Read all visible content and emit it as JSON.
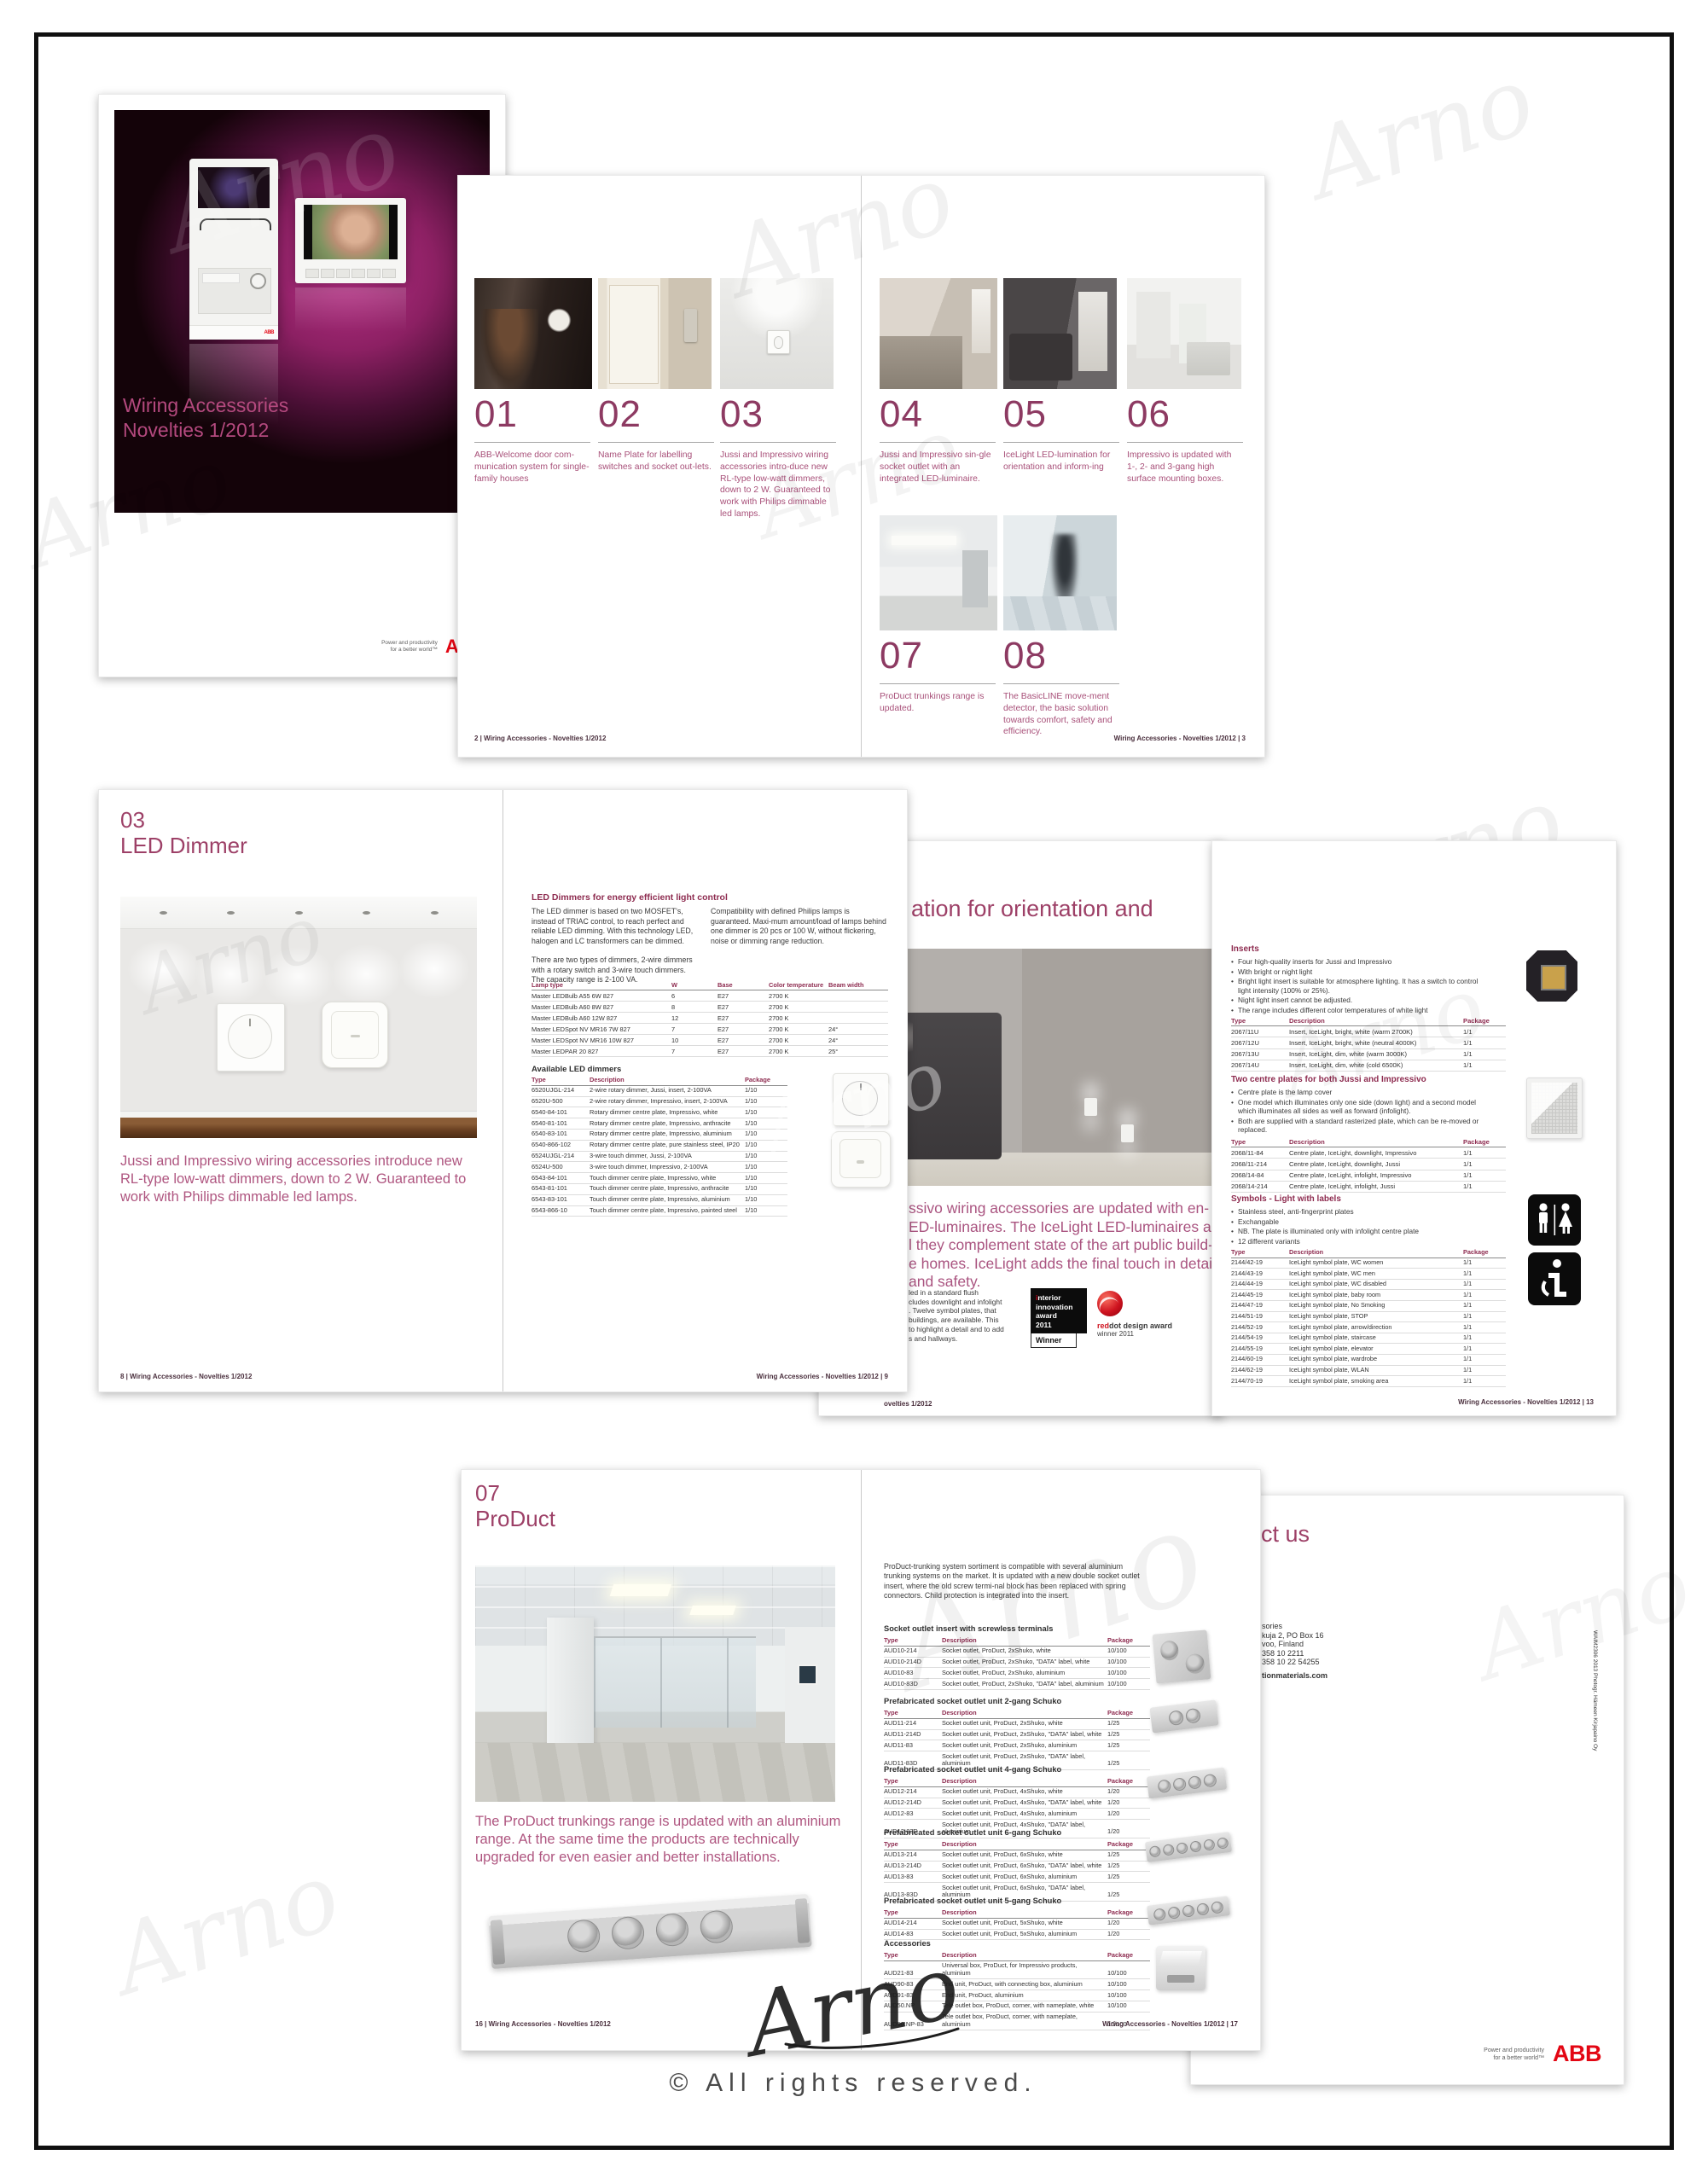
{
  "watermark": {
    "text": "Arno"
  },
  "signature": {
    "text": "Arno"
  },
  "copyright": "© All rights reserved.",
  "brand": {
    "abb": "ABB",
    "tagline1": "Power and productivity",
    "tagline2": "for a better world™"
  },
  "cover": {
    "title1": "Wiring Accessories",
    "title2": "Novelties 1/2012"
  },
  "spread1": {
    "footer_left": "2 | Wiring Accessories - Novelties 1/2012",
    "footer_right": "Wiring Accessories - Novelties 1/2012 | 3",
    "items": [
      {
        "num": "01",
        "text": "ABB-Welcome door com-munication system for single-family houses"
      },
      {
        "num": "02",
        "text": "Name Plate for labelling switches and socket out-lets."
      },
      {
        "num": "03",
        "text": "Jussi and Impressivo wiring accessories intro-duce new RL-type low-watt dimmers, down to 2 W. Guaranteed to work with Philips dimmable led lamps."
      },
      {
        "num": "04",
        "text": "Jussi and Impressivo sin-gle socket outlet with an integrated LED-luminaire."
      },
      {
        "num": "05",
        "text": "IceLight LED-lumination for orientation and inform-ing"
      },
      {
        "num": "06",
        "text": "Impressivo is updated with 1-, 2- and 3-gang high surface mounting boxes."
      },
      {
        "num": "07",
        "text": "ProDuct trunkings range is updated."
      },
      {
        "num": "08",
        "text": "The BasicLINE move-ment detector, the basic solution towards comfort, safety and efficiency."
      }
    ]
  },
  "led": {
    "num": "03",
    "title": "LED Dimmer",
    "paragraph": "Jussi and Impressivo wiring accessories introduce new RL-type low-watt dimmers, down to 2 W. Guaranteed to work with Philips dimmable led lamps.",
    "footer_left": "8 | Wiring Accessories - Novelties 1/2012",
    "footer_right": "Wiring Accessories - Novelties 1/2012 | 9",
    "heading": "LED Dimmers for energy efficient light control",
    "col1a": "The LED dimmer is based on two MOSFET's, instead of TRIAC control, to reach perfect and reliable LED dimming. With this technology LED, halogen and LC transformers can be dimmed.",
    "col1b": "There are two types of dimmers, 2-wire dimmers with a rotary switch and 3-wire touch dimmers. The capacity range is 2-100 VA.",
    "col2": "Compatibility with defined Philips lamps is guaranteed. Maxi-mum amount/load of lamps behind one dimmer is 20 pcs or 100 W, without flickering, noise or dimming range reduction.",
    "lamp_headers": [
      "Lamp type",
      "W",
      "Base",
      "Color temperature",
      "Beam width"
    ],
    "lamp_rows": [
      [
        "Master LEDBulb A55 6W 827",
        "6",
        "E27",
        "2700 K",
        ""
      ],
      [
        "Master LEDBulb A60 8W 827",
        "8",
        "E27",
        "2700 K",
        ""
      ],
      [
        "Master LEDBulb A60 12W 827",
        "12",
        "E27",
        "2700 K",
        ""
      ],
      [
        "Master LEDSpot NV MR16 7W 827",
        "7",
        "E27",
        "2700 K",
        "24°"
      ],
      [
        "Master LEDSpot NV MR16 10W 827",
        "10",
        "E27",
        "2700 K",
        "24°"
      ],
      [
        "Master LEDPAR 20 827",
        "7",
        "E27",
        "2700 K",
        "25°"
      ]
    ],
    "dimmers_heading": "Available LED dimmers",
    "tdp_headers": [
      "Type",
      "Description",
      "Package"
    ],
    "dimmer_rows": [
      [
        "6520UJGL-214",
        "2-wire rotary dimmer, Jussi, insert, 2-100VA",
        "1/10"
      ],
      [
        "6520U-500",
        "2-wire rotary dimmer, Impressivo, insert, 2-100VA",
        "1/10"
      ],
      [
        "6540-84-101",
        "Rotary dimmer centre plate, Impressivo, white",
        "1/10"
      ],
      [
        "6540-81-101",
        "Rotary dimmer centre plate, Impressivo, anthracite",
        "1/10"
      ],
      [
        "6540-83-101",
        "Rotary dimmer centre plate, Impressivo, aluminium",
        "1/10"
      ],
      [
        "6540-866-102",
        "Rotary dimmer centre plate, pure stainless steel, IP20",
        "1/10"
      ],
      [
        "6524UJGL-214",
        "3-wire touch dimmer, Jussi, 2-100VA",
        "1/10"
      ],
      [
        "6524U-500",
        "3-wire touch dimmer, Impressivo, 2-100VA",
        "1/10"
      ],
      [
        "6543-84-101",
        "Touch dimmer centre plate, Impressivo, white",
        "1/10"
      ],
      [
        "6543-81-101",
        "Touch dimmer centre plate, Impressivo, anthracite",
        "1/10"
      ],
      [
        "6543-83-101",
        "Touch dimmer centre plate, Impressivo, aluminium",
        "1/10"
      ],
      [
        "6543-866-10",
        "Touch dimmer centre plate, Impressivo, painted steel",
        "1/10"
      ]
    ]
  },
  "ice": {
    "heading_fragment": "ation for orientation and",
    "body_lines": [
      "ssivo wiring accessories are updated with en-",
      "ED-luminaires. The IceLight LED-luminaires are",
      "l they complement state of the art public build-",
      "e homes. IceLight adds the final touch in detail",
      "and safety."
    ],
    "small_lines": [
      "led in a standard flush",
      "cludes downlight and infolight",
      ". Twelve symbol plates, that",
      "buildings, are available. This",
      "to highlight a detail and to add",
      "s and hallways."
    ],
    "award1": {
      "i": "i",
      "line1": "nterior",
      "line2": "innovation",
      "line3": "award",
      "line4": "2011",
      "winner": "Winner"
    },
    "award2": {
      "red": "red",
      "rest": "dot design award",
      "line2": "winner 2011"
    },
    "footer_fragment": "ovelties 1/2012",
    "right": {
      "headers": [
        "Type",
        "Description",
        "Package"
      ],
      "inserts_heading": "Inserts",
      "inserts_bullets": [
        "Four high-quality inserts for Jussi and Impressivo",
        "With bright or night light",
        "Bright light insert is suitable for atmosphere lighting. It has a switch to control light intensity (100% or 25%).",
        "Night light insert cannot be adjusted.",
        "The range includes different color temperatures of white light"
      ],
      "inserts_rows": [
        [
          "2067/11U",
          "Insert, IceLight, bright, white (warm 2700K)",
          "1/1"
        ],
        [
          "2067/12U",
          "Insert, IceLight, bright, white (neutral 4000K)",
          "1/1"
        ],
        [
          "2067/13U",
          "Insert, IceLight, dim, white (warm 3000K)",
          "1/1"
        ],
        [
          "2067/14U",
          "Insert, IceLight, dim, white (cold 6500K)",
          "1/1"
        ]
      ],
      "plates_heading": "Two centre plates for both Jussi and Impressivo",
      "plates_bullets": [
        "Centre plate is the lamp cover",
        "One model which illuminates only one side (down light) and a second model which illuminates all sides as well as forward (infolight).",
        "Both are supplied with a standard rasterized plate, which can be re-moved or replaced."
      ],
      "plates_rows": [
        [
          "2068/11-84",
          "Centre plate, IceLight, downlight, Impressivo",
          "1/1"
        ],
        [
          "2068/11-214",
          "Centre plate, IceLight, downlight, Jussi",
          "1/1"
        ],
        [
          "2068/14-84",
          "Centre plate, IceLight, infolight, Impressivo",
          "1/1"
        ],
        [
          "2068/14-214",
          "Centre plate, IceLight, infolight, Jussi",
          "1/1"
        ]
      ],
      "symbols_heading": "Symbols - Light with labels",
      "symbols_bullets": [
        "Stainless steel, anti-fingerprint plates",
        "Exchangable",
        "NB. The plate is illuminated only with infolight centre plate",
        "12 different variants"
      ],
      "symbols_rows": [
        [
          "2144/42-19",
          "IceLight symbol plate, WC women",
          "1/1"
        ],
        [
          "2144/43-19",
          "IceLight symbol plate, WC men",
          "1/1"
        ],
        [
          "2144/44-19",
          "IceLight symbol plate, WC disabled",
          "1/1"
        ],
        [
          "2144/45-19",
          "IceLight symbol plate, baby room",
          "1/1"
        ],
        [
          "2144/47-19",
          "IceLight symbol plate, No Smoking",
          "1/1"
        ],
        [
          "2144/51-19",
          "IceLight symbol plate, STOP",
          "1/1"
        ],
        [
          "2144/52-19",
          "IceLight symbol plate, arrow/direction",
          "1/1"
        ],
        [
          "2144/54-19",
          "IceLight symbol plate, staircase",
          "1/1"
        ],
        [
          "2144/55-19",
          "IceLight symbol plate, elevator",
          "1/1"
        ],
        [
          "2144/60-19",
          "IceLight symbol plate, wardrobe",
          "1/1"
        ],
        [
          "2144/62-19",
          "IceLight symbol plate, WLAN",
          "1/1"
        ],
        [
          "2144/70-19",
          "IceLight symbol plate, smoking area",
          "1/1"
        ]
      ],
      "footer": "Wiring Accessories - Novelties 1/2012 | 13"
    }
  },
  "product": {
    "num": "07",
    "title": "ProDuct",
    "paragraph": "The ProDuct trunkings range is updated with an aluminium range. At the same time the products are technically upgraded for even easier and better installations.",
    "footer_left": "16 | Wiring Accessories - Novelties 1/2012",
    "footer_right": "Wiring Accessories - Novelties 1/2012 | 17",
    "intro": "ProDuct-trunking system sortiment is compatible with several aluminium trunking systems on the market. It is updated with a new double socket outlet insert, where the old screw termi-nal block has been replaced with spring connectors. Child protection is integrated into the insert.",
    "headers": [
      "Type",
      "Description",
      "Package"
    ],
    "sections": [
      {
        "heading": "Socket outlet insert with screwless terminals",
        "rows": [
          [
            "AUD10-214",
            "Socket outlet, ProDuct, 2xShuko, white",
            "10/100"
          ],
          [
            "AUD10-214D",
            "Socket outlet, ProDuct, 2xShuko, \"DATA\" label, white",
            "10/100"
          ],
          [
            "AUD10-83",
            "Socket outlet, ProDuct, 2xShuko, aluminium",
            "10/100"
          ],
          [
            "AUD10-83D",
            "Socket outlet, ProDuct, 2xShuko, \"DATA\" label, aluminium",
            "10/100"
          ]
        ]
      },
      {
        "heading": "Prefabricated socket outlet unit 2-gang Schuko",
        "rows": [
          [
            "AUD11-214",
            "Socket outlet unit, ProDuct, 2xShuko, white",
            "1/25"
          ],
          [
            "AUD11-214D",
            "Socket outlet unit, ProDuct, 2xShuko, \"DATA\" label, white",
            "1/25"
          ],
          [
            "AUD11-83",
            "Socket outlet unit, ProDuct, 2xShuko, aluminium",
            "1/25"
          ],
          [
            "AUD11-83D",
            "Socket outlet unit, ProDuct, 2xShuko, \"DATA\" label, aluminium",
            "1/25"
          ]
        ]
      },
      {
        "heading": "Prefabricated socket outlet unit 4-gang Schuko",
        "rows": [
          [
            "AUD12-214",
            "Socket outlet unit, ProDuct, 4xShuko, white",
            "1/20"
          ],
          [
            "AUD12-214D",
            "Socket outlet unit, ProDuct, 4xShuko, \"DATA\" label, white",
            "1/20"
          ],
          [
            "AUD12-83",
            "Socket outlet unit, ProDuct, 4xShuko, aluminium",
            "1/20"
          ],
          [
            "AUD12-83D",
            "Socket outlet unit, ProDuct, 4xShuko, \"DATA\" label, aluminium",
            "1/20"
          ]
        ]
      },
      {
        "heading": "Prefabricated socket outlet unit 6-gang Schuko",
        "rows": [
          [
            "AUD13-214",
            "Socket outlet unit, ProDuct, 6xShuko, white",
            "1/25"
          ],
          [
            "AUD13-214D",
            "Socket outlet unit, ProDuct, 6xShuko, \"DATA\" label, white",
            "1/25"
          ],
          [
            "AUD13-83",
            "Socket outlet unit, ProDuct, 6xShuko, aluminium",
            "1/25"
          ],
          [
            "AUD13-83D",
            "Socket outlet unit, ProDuct, 6xShuko, \"DATA\" label, aluminium",
            "1/25"
          ]
        ]
      },
      {
        "heading": "Prefabricated socket outlet unit 5-gang Schuko",
        "rows": [
          [
            "AUD14-214",
            "Socket outlet unit, ProDuct, 5xShuko, white",
            "1/20"
          ],
          [
            "AUD14-83",
            "Socket outlet unit, ProDuct, 5xShuko, aluminium",
            "1/20"
          ]
        ]
      },
      {
        "heading": "Accessories",
        "rows": [
          [
            "AUD21-83",
            "Universal box, ProDuct, for Impressivo products, aluminium",
            "10/100"
          ],
          [
            "AUD90-83",
            "End unit, ProDuct, with connecting box, aluminium",
            "10/100"
          ],
          [
            "AUD91-83",
            "End unit, ProDuct, aluminium",
            "10/100"
          ],
          [
            "AUD50.NP",
            "Tele outlet box, ProDuct, corner, with nameplate, white",
            "10/100"
          ],
          [
            "AUD50.NP-83",
            "Tele outlet box, ProDuct, corner, with nameplate, aluminium",
            "10/100"
          ]
        ]
      }
    ]
  },
  "contact": {
    "heading_fragment": "ct us",
    "lines": [
      "sories",
      "kuja 2, PO Box 16",
      "voo, Finland",
      "358 10 2211",
      "358 10 22 54255"
    ],
    "web": "tionmaterials.com",
    "side_text": "WAIM2306 2013 Photogr. Hämeen Kirjapaino Oy"
  }
}
